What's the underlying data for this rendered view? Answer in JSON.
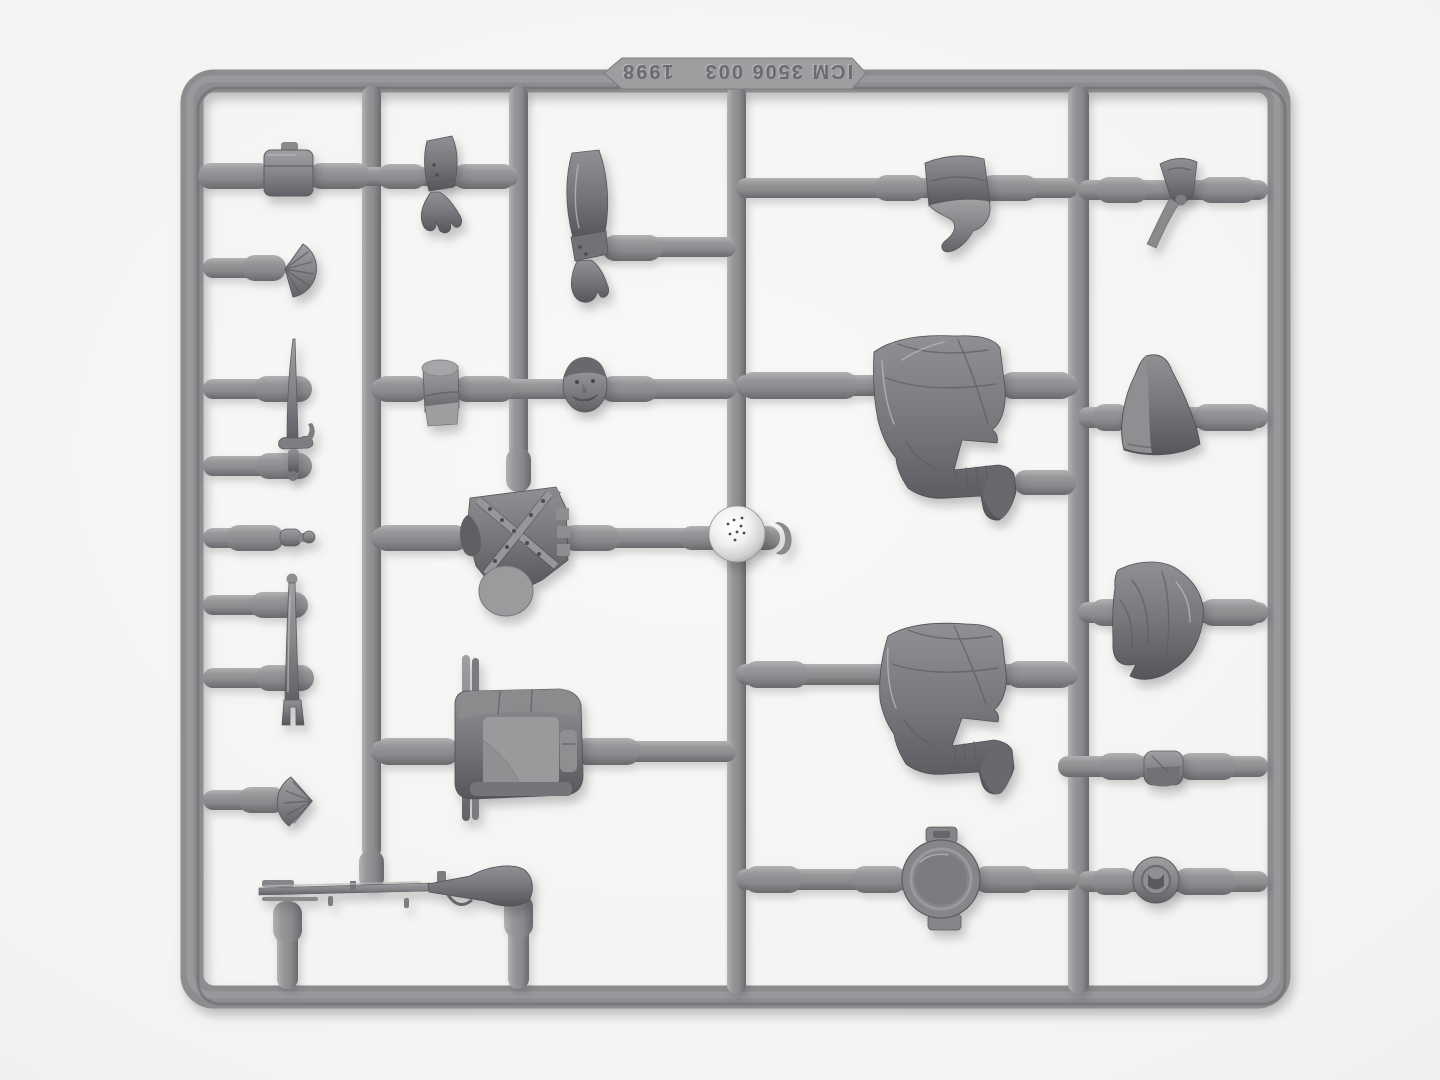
{
  "scene": {
    "type": "photograph",
    "subject": "Gray polystyrene injection-molded sprue (model kit parts frame) with 1:35 Napoleonic infantry figure parts on a white background",
    "background_color": "#f3f3f1",
    "plastic_color": "#8d8d90",
    "plastic_shadow": "#65656a",
    "plastic_highlight": "#b9b9bb"
  },
  "mold_text": {
    "part_number": "ICM 3506 003",
    "year": "1998",
    "orientation": "rotated 180 degrees (upside-down embossed lettering on top rail)"
  },
  "parts": [
    {
      "name": "cartridge-pouch",
      "label": "small cartridge pouch"
    },
    {
      "name": "fan-plume",
      "label": "fan shaped plume / cockade"
    },
    {
      "name": "sword-bayonet",
      "label": "sword bayonet with cross guard"
    },
    {
      "name": "small-fitting",
      "label": "small cylindrical fitting with ball end"
    },
    {
      "name": "scabbard",
      "label": "long scabbard with forked frog end"
    },
    {
      "name": "shell-plume",
      "label": "scalloped round plume"
    },
    {
      "name": "bent-arm",
      "label": "bent arm with open hand"
    },
    {
      "name": "straight-arm",
      "label": "straight arm with cuff and hand"
    },
    {
      "name": "shako",
      "label": "cylindrical shako cap"
    },
    {
      "name": "head",
      "label": "head with mustache"
    },
    {
      "name": "torso",
      "label": "jacket torso with crossed belts"
    },
    {
      "name": "round-ball",
      "label": "shiny round ball at runner junction"
    },
    {
      "name": "strap-hook",
      "label": "small curved strap hook"
    },
    {
      "name": "backpack",
      "label": "backpack with bedroll and side rods"
    },
    {
      "name": "musket",
      "label": "flintlock musket"
    },
    {
      "name": "forage-cap",
      "label": "forage cap with curled tail"
    },
    {
      "name": "legs-kneeling-a",
      "label": "draped legs with boot (upper)"
    },
    {
      "name": "legs-kneeling-b",
      "label": "draped legs with boot (lower)"
    },
    {
      "name": "canteen",
      "label": "round canteen / mess tin lid"
    },
    {
      "name": "streamer-cap",
      "label": "small cap with hanging streamer"
    },
    {
      "name": "shako-cover",
      "label": "conical shako cover"
    },
    {
      "name": "hood-drape",
      "label": "draped hood"
    },
    {
      "name": "belt-pouch",
      "label": "small belt pouch"
    },
    {
      "name": "cockade-disc",
      "label": "round cockade disc"
    }
  ]
}
